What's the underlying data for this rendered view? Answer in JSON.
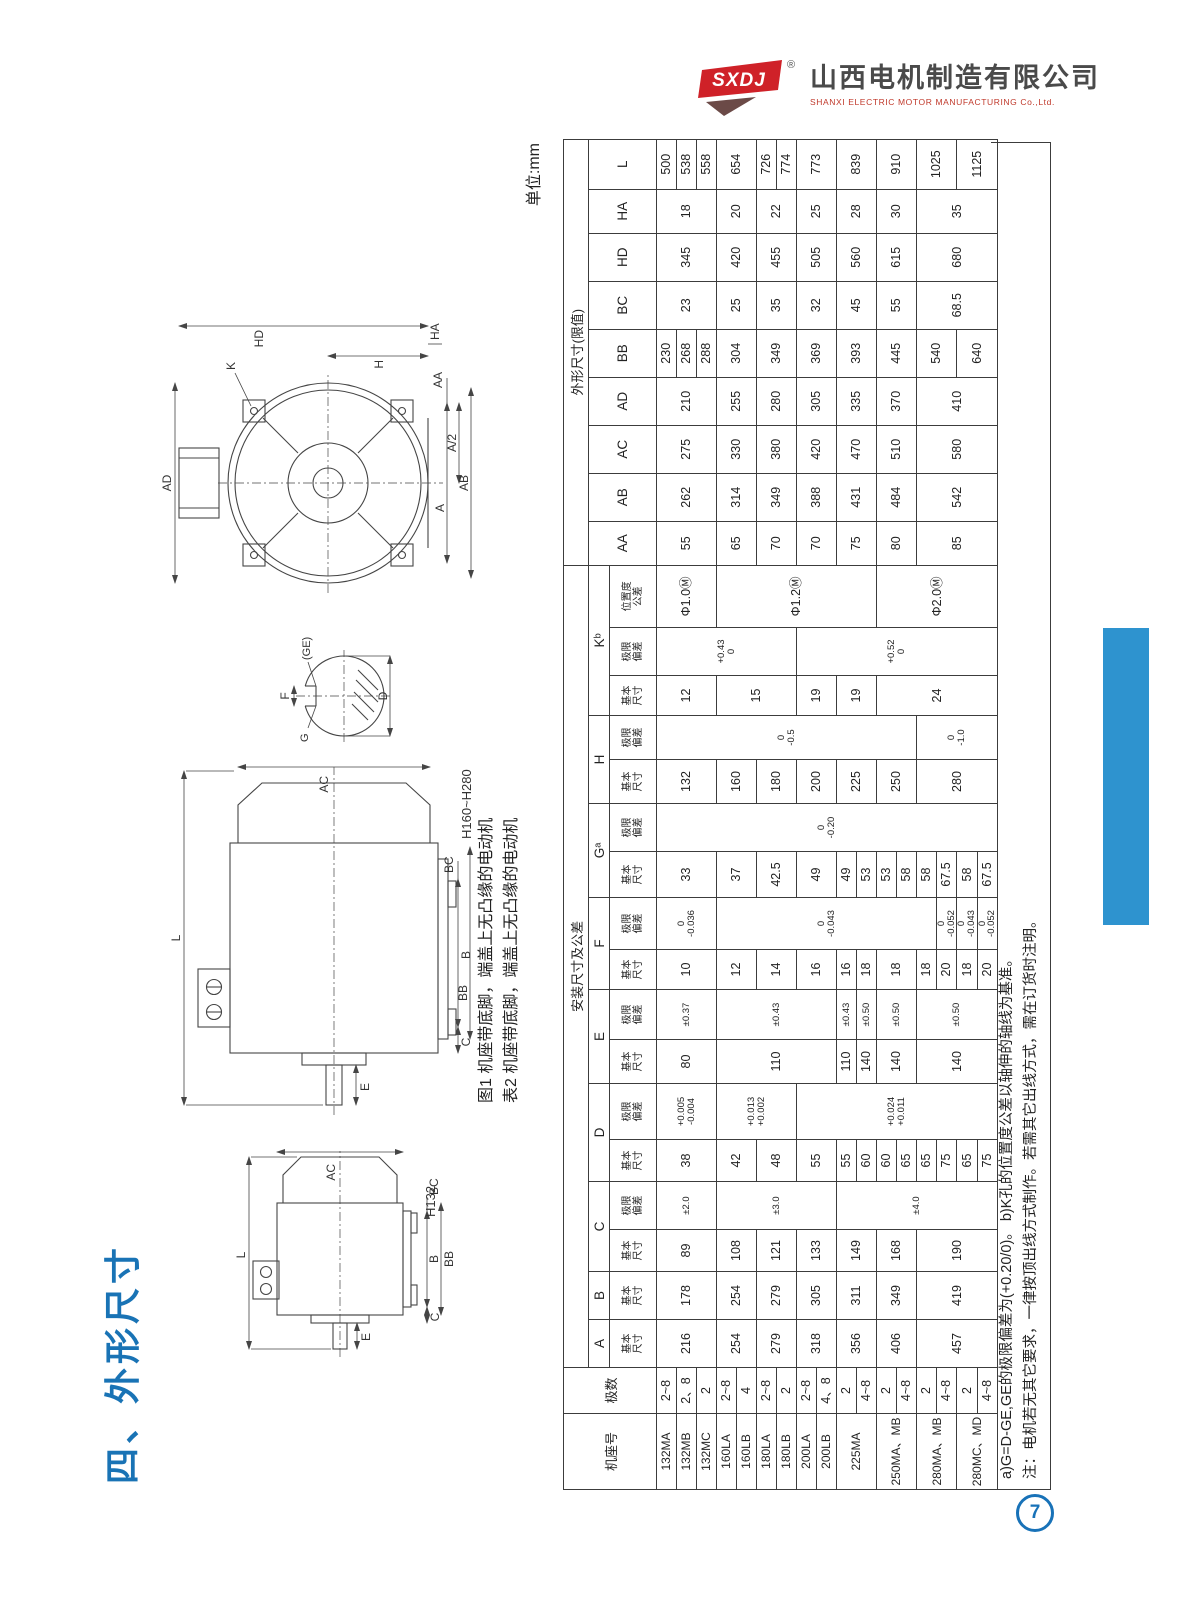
{
  "colors": {
    "accent_blue": "#1973b5",
    "tab_blue": "#2e93cf",
    "logo_red": "#cf2128",
    "ink": "#2e2e2e"
  },
  "page": {
    "title": "四、外形尺寸",
    "unit": "单位:mm",
    "page_number": "7"
  },
  "logo": {
    "mark": "SXDJ",
    "reg": "®",
    "company_cn": "山西电机制造有限公司",
    "company_en": "SHANXI ELECTRIC MOTOR MANUFACTURING Co.,Ltd."
  },
  "captions": {
    "fig1": "图1 机座带底脚，端盖上无凸缘的电动机",
    "tab2": "表2 机座带底脚，端盖上无凸缘的电动机"
  },
  "notes": {
    "line1": "a)G=D-GE,GE的极限偏差为(+0.20/0)。 b)K孔的位置度公差以轴伸的轴线为基准。",
    "line2": "注：电机若无其它要求，一律按顶出线方式制作。若需其它出线方式，需在订货时注明。"
  },
  "drawings": {
    "side_small": {
      "model": "H132",
      "l": "L",
      "ac": "AC",
      "b": "B",
      "bb": "BB",
      "c": "C",
      "bc": "BC",
      "e": "E"
    },
    "side_large": {
      "model": "H160~H280",
      "l": "L",
      "ac": "AC",
      "b": "B",
      "bb": "BB",
      "c": "C",
      "bc": "BC",
      "e": "E"
    },
    "front": {
      "hd": "HD",
      "ha": "HA",
      "ad": "AD",
      "k": "K",
      "a": "A",
      "ab": "AB",
      "a2": "A/2",
      "aa": "AA",
      "h": "H"
    },
    "shaft": {
      "f": "F",
      "g": "G",
      "ge": "(GE)",
      "d": "D"
    }
  },
  "table": {
    "row_count": 17,
    "headers": {
      "frame": "机座号",
      "poles": "极数",
      "install": "安装尺寸及公差",
      "outline": "外形尺寸(限值)",
      "dims": [
        "A",
        "B",
        "C",
        "D",
        "E",
        "F",
        "Gᵃ",
        "H",
        "Kᵇ"
      ],
      "outline_dims": [
        "AA",
        "AB",
        "AC",
        "AD",
        "BB",
        "BC",
        "HD",
        "HA",
        "L"
      ],
      "sub_basic": "基本\n尺寸",
      "sub_dev": "极限\n偏差",
      "sub_pos": "位置度\n公差"
    },
    "columns": [
      {
        "w": 76,
        "cls": "frame",
        "cells": [
          [
            "132MA",
            1
          ],
          [
            "132MB",
            1
          ],
          [
            "132MC",
            1
          ],
          [
            "160LA",
            1
          ],
          [
            "160LB",
            1
          ],
          [
            "180LA",
            1
          ],
          [
            "180LB",
            1
          ],
          [
            "200LA",
            1
          ],
          [
            "200LB",
            1
          ],
          [
            "225MA",
            2
          ],
          [
            "250MA、MB",
            2
          ],
          [
            "280MA、MB",
            2
          ],
          [
            "280MC、MD",
            2
          ]
        ]
      },
      {
        "w": 46,
        "cells": [
          [
            "2~8",
            1
          ],
          [
            "2、8",
            1
          ],
          [
            "2",
            1
          ],
          [
            "2~8",
            1
          ],
          [
            "4",
            1
          ],
          [
            "2~8",
            1
          ],
          [
            "2",
            1
          ],
          [
            "2~8",
            1
          ],
          [
            "4、8",
            1
          ],
          [
            "2",
            1
          ],
          [
            "4~8",
            1
          ],
          [
            "2",
            1
          ],
          [
            "4~8",
            1
          ],
          [
            "2",
            1
          ],
          [
            "4~8",
            1
          ],
          [
            "2",
            1
          ],
          [
            "4~8",
            1
          ]
        ]
      },
      {
        "w": 48,
        "cells": [
          [
            "216",
            3
          ],
          [
            "254",
            2
          ],
          [
            "279",
            2
          ],
          [
            "318",
            2
          ],
          [
            "356",
            2
          ],
          [
            "406",
            2
          ],
          [
            "457",
            4
          ]
        ]
      },
      {
        "w": 48,
        "cells": [
          [
            "178",
            3
          ],
          [
            "254",
            2
          ],
          [
            "279",
            2
          ],
          [
            "305",
            2
          ],
          [
            "311",
            2
          ],
          [
            "349",
            2
          ],
          [
            "419",
            4
          ]
        ]
      },
      {
        "w": 42,
        "cells": [
          [
            "89",
            3
          ],
          [
            "108",
            2
          ],
          [
            "121",
            2
          ],
          [
            "133",
            2
          ],
          [
            "149",
            2
          ],
          [
            "168",
            2
          ],
          [
            "190",
            4
          ]
        ]
      },
      {
        "w": 48,
        "cls": "tol",
        "cells": [
          [
            "±2.0",
            3
          ],
          [
            "±3.0",
            6
          ],
          [
            "±4.0",
            8
          ]
        ]
      },
      {
        "w": 42,
        "cells": [
          [
            "38",
            3
          ],
          [
            "42",
            2
          ],
          [
            "48",
            2
          ],
          [
            "55",
            2
          ],
          [
            "55",
            1
          ],
          [
            "60",
            1
          ],
          [
            "60",
            1
          ],
          [
            "65",
            1
          ],
          [
            "65",
            1
          ],
          [
            "75",
            1
          ],
          [
            "65",
            1
          ],
          [
            "75",
            1
          ]
        ]
      },
      {
        "w": 56,
        "cls": "tol",
        "cells": [
          [
            "+0.005\n-0.004",
            3
          ],
          [
            "+0.013\n+0.002",
            4
          ],
          [
            "+0.024\n+0.011",
            10
          ]
        ]
      },
      {
        "w": 44,
        "cells": [
          [
            "80",
            3
          ],
          [
            "110",
            6
          ],
          [
            "110",
            1
          ],
          [
            "140",
            1
          ],
          [
            "140",
            2
          ],
          [
            "140",
            4
          ]
        ]
      },
      {
        "w": 50,
        "cls": "tol",
        "cells": [
          [
            "±0.37",
            3
          ],
          [
            "±0.43",
            6
          ],
          [
            "±0.43",
            1
          ],
          [
            "±0.50",
            1
          ],
          [
            "±0.50",
            2
          ],
          [
            "±0.50",
            4
          ]
        ]
      },
      {
        "w": 40,
        "cells": [
          [
            "10",
            3
          ],
          [
            "12",
            2
          ],
          [
            "14",
            2
          ],
          [
            "16",
            2
          ],
          [
            "16",
            1
          ],
          [
            "18",
            1
          ],
          [
            "18",
            2
          ],
          [
            "18",
            1
          ],
          [
            "20",
            1
          ],
          [
            "18",
            1
          ],
          [
            "20",
            1
          ]
        ]
      },
      {
        "w": 52,
        "cls": "tol",
        "cells": [
          [
            "0\n-0.036",
            3
          ],
          [
            "0\n-0.043",
            11
          ],
          [
            "0\n-0.052",
            1
          ],
          [
            "0\n-0.043",
            1
          ],
          [
            "0\n-0.052",
            1
          ]
        ]
      },
      {
        "w": 46,
        "cells": [
          [
            "33",
            3
          ],
          [
            "37",
            2
          ],
          [
            "42.5",
            2
          ],
          [
            "49",
            2
          ],
          [
            "49",
            1
          ],
          [
            "53",
            1
          ],
          [
            "53",
            1
          ],
          [
            "58",
            1
          ],
          [
            "58",
            1
          ],
          [
            "67.5",
            1
          ],
          [
            "58",
            1
          ],
          [
            "67.5",
            1
          ]
        ]
      },
      {
        "w": 48,
        "cls": "tol",
        "cells": [
          [
            "0\n-0.20",
            17
          ]
        ]
      },
      {
        "w": 44,
        "cells": [
          [
            "132",
            3
          ],
          [
            "160",
            2
          ],
          [
            "180",
            2
          ],
          [
            "200",
            2
          ],
          [
            "225",
            2
          ],
          [
            "250",
            2
          ],
          [
            "280",
            4
          ]
        ]
      },
      {
        "w": 44,
        "cls": "tol",
        "cells": [
          [
            "0\n-0.5",
            13
          ],
          [
            "0\n-1.0",
            4
          ]
        ]
      },
      {
        "w": 40,
        "cells": [
          [
            "12",
            3
          ],
          [
            "15",
            4
          ],
          [
            "19",
            2
          ],
          [
            "19",
            2
          ],
          [
            "24",
            6
          ]
        ]
      },
      {
        "w": 48,
        "cls": "tol",
        "cells": [
          [
            "+0.43\n0",
            7
          ],
          [
            "+0.52\n0",
            10
          ]
        ]
      },
      {
        "w": 62,
        "cells": [
          [
            "Φ1.0Ⓜ",
            3
          ],
          [
            "Φ1.2Ⓜ",
            8
          ],
          [
            "Φ2.0Ⓜ",
            6
          ]
        ]
      },
      {
        "w": 44,
        "cells": [
          [
            "55",
            3
          ],
          [
            "65",
            2
          ],
          [
            "70",
            2
          ],
          [
            "70",
            2
          ],
          [
            "75",
            2
          ],
          [
            "80",
            2
          ],
          [
            "85",
            4
          ]
        ]
      },
      {
        "w": 48,
        "cells": [
          [
            "262",
            3
          ],
          [
            "314",
            2
          ],
          [
            "349",
            2
          ],
          [
            "388",
            2
          ],
          [
            "431",
            2
          ],
          [
            "484",
            2
          ],
          [
            "542",
            4
          ]
        ]
      },
      {
        "w": 48,
        "cells": [
          [
            "275",
            3
          ],
          [
            "330",
            2
          ],
          [
            "380",
            2
          ],
          [
            "420",
            2
          ],
          [
            "470",
            2
          ],
          [
            "510",
            2
          ],
          [
            "580",
            4
          ]
        ]
      },
      {
        "w": 48,
        "cells": [
          [
            "210",
            3
          ],
          [
            "255",
            2
          ],
          [
            "280",
            2
          ],
          [
            "305",
            2
          ],
          [
            "335",
            2
          ],
          [
            "370",
            2
          ],
          [
            "410",
            4
          ]
        ]
      },
      {
        "w": 48,
        "cells": [
          [
            "230",
            1
          ],
          [
            "268",
            1
          ],
          [
            "288",
            1
          ],
          [
            "304",
            2
          ],
          [
            "349",
            2
          ],
          [
            "369",
            2
          ],
          [
            "393",
            2
          ],
          [
            "445",
            2
          ],
          [
            "540",
            2
          ],
          [
            "640",
            2
          ]
        ]
      },
      {
        "w": 48,
        "cells": [
          [
            "23",
            3
          ],
          [
            "25",
            2
          ],
          [
            "35",
            2
          ],
          [
            "32",
            2
          ],
          [
            "45",
            2
          ],
          [
            "55",
            2
          ],
          [
            "68.5",
            4
          ]
        ]
      },
      {
        "w": 48,
        "cells": [
          [
            "345",
            3
          ],
          [
            "420",
            2
          ],
          [
            "455",
            2
          ],
          [
            "505",
            2
          ],
          [
            "560",
            2
          ],
          [
            "615",
            2
          ],
          [
            "680",
            4
          ]
        ]
      },
      {
        "w": 44,
        "cells": [
          [
            "18",
            3
          ],
          [
            "20",
            2
          ],
          [
            "22",
            2
          ],
          [
            "25",
            2
          ],
          [
            "28",
            2
          ],
          [
            "30",
            2
          ],
          [
            "35",
            4
          ]
        ]
      },
      {
        "w": 50,
        "cells": [
          [
            "500",
            1
          ],
          [
            "538",
            1
          ],
          [
            "558",
            1
          ],
          [
            "654",
            2
          ],
          [
            "726",
            1
          ],
          [
            "774",
            1
          ],
          [
            "773",
            2
          ],
          [
            "839",
            2
          ],
          [
            "910",
            2
          ],
          [
            "1025",
            2
          ],
          [
            "1125",
            2
          ]
        ]
      }
    ]
  }
}
